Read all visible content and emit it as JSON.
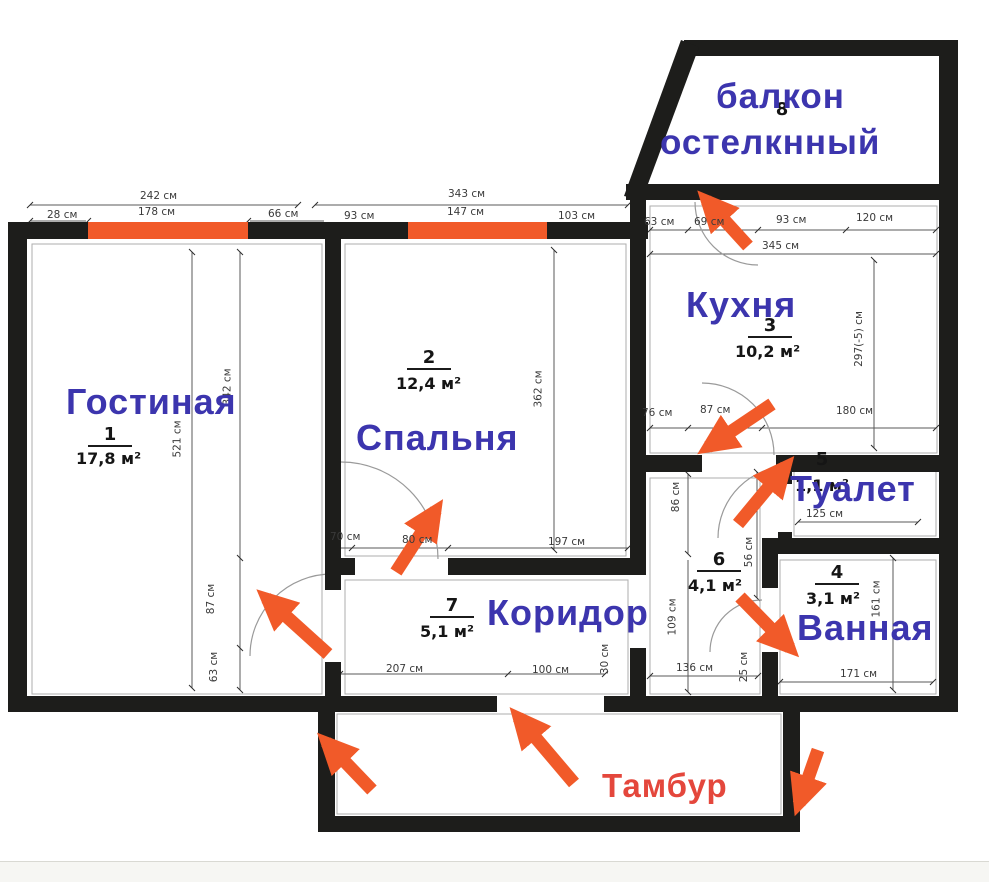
{
  "colors": {
    "room_label_blue": "#3c35ae",
    "tambur_label_red": "#e4473c",
    "accent_orange": "#f15a29",
    "wall_black": "#1d1d1b"
  },
  "rooms": {
    "living": {
      "label": "Гостиная",
      "number": "1",
      "area": "17,8 м²"
    },
    "bedroom": {
      "label": "Спальня",
      "number": "2",
      "area": "12,4 м²"
    },
    "kitchen": {
      "label": "Кухня",
      "number": "3",
      "area": "10,2 м²"
    },
    "bathroom": {
      "label": "Ванная",
      "number": "4",
      "area": "3,1 м²"
    },
    "toilet": {
      "label": "Туалет",
      "number": "5",
      "area": "1,1 м²"
    },
    "hall": {
      "label": "Коридор",
      "number": "6",
      "area": "4,1 м²"
    },
    "corridor": {
      "number": "7",
      "area": "5,1 м²"
    },
    "balcony": {
      "label_line1": "балкон",
      "label_line2": "остелкнный",
      "number": "8"
    },
    "tambur": {
      "label": "Тамбур"
    }
  },
  "dims": {
    "lr_width_total": "242 см",
    "lr_top_a": "28 см",
    "lr_top_window": "178 см",
    "lr_top_b": "66 см",
    "br_width_total": "343 см",
    "br_top_a": "93 см",
    "br_top_window": "147 см",
    "br_top_b": "103 см",
    "kt_top_a": "63 см",
    "kt_top_b": "69 см",
    "kt_top_c": "93 см",
    "kt_top_d": "120 см",
    "kt_width_total": "345 см",
    "kt_height": "297(-5) см",
    "kt_bot_a": "76 см",
    "kt_bot_b": "87 см",
    "kt_bot_c": "180 см",
    "lr_height": "521 см",
    "lr_inner_v": "342 см",
    "lr_bot_v1": "87 см",
    "lr_bot_v2": "63 см",
    "br_height": "362 см",
    "br_bot_a": "70 см",
    "br_bot_b": "80 см",
    "br_bot_c": "197 см",
    "c7_bot_a": "207 см",
    "c7_bot_b": "100 см",
    "c7_side": "30 см",
    "h6_top_v": "86 см",
    "h6_mid_v": "56 см",
    "h6_left_v": "109 см",
    "h6_bot": "136 см",
    "h6_bot_v": "25 см",
    "wc_width": "125 см",
    "bath_bot": "171 см",
    "bath_right": "161 см"
  }
}
